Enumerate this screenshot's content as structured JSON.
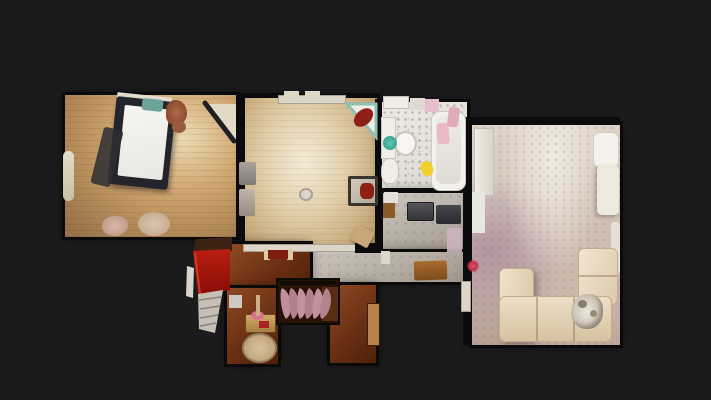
{
  "viewer": {
    "kind": "top-down dollhouse floor plan photograph",
    "background_color": "#1b1b1d",
    "visible_text": ""
  },
  "floorplan": {
    "rooms": [
      {
        "name": "bedroom",
        "floor": "tan wood",
        "floor_color": "#b98f5c",
        "items": [
          "double-bed",
          "white-mattress",
          "teal-pillow",
          "red-clothes",
          "radiator",
          "clothes-piles",
          "open-door"
        ]
      },
      {
        "name": "nursery",
        "floor": "pale wood",
        "floor_color": "#d8c49c",
        "items": [
          "corner-crib-red-blanket",
          "window-radiator",
          "wall-shelves",
          "potty",
          "dresser-red-item",
          "stool",
          "red-doormat"
        ]
      },
      {
        "name": "bathroom",
        "floor": "white tile",
        "floor_color": "#e4e1db",
        "items": [
          "bathtub",
          "vanity",
          "oval-sink",
          "teal-basin",
          "toilet",
          "pink-towels",
          "yellow-toy",
          "shelf-boxes"
        ]
      },
      {
        "name": "hallway",
        "floor": "grey screed",
        "floor_color": "#b6aea4",
        "items": [
          "washing-machine",
          "dryer",
          "brown-doormat",
          "white-shelf",
          "pink-wall-patch"
        ]
      },
      {
        "name": "living-room",
        "floor": "mottled beige carpet",
        "floor_color": "#cfc1b5",
        "items": [
          "l-shaped-cream-sofa",
          "white-armchair",
          "wall-cabinet",
          "radiator",
          "white-door",
          "dog-on-sofa"
        ]
      },
      {
        "name": "landing",
        "floor": "dark red-brown wood",
        "floor_color": "#6b3014",
        "items": [
          "curved-staircase-pink-treads",
          "red-carpet-staircase",
          "side-table-flowers",
          "oval-rug",
          "doorway-posts"
        ]
      }
    ],
    "marker": {
      "type": "scan-point-dot",
      "color": "#c23049"
    }
  },
  "palette": {
    "wall": "#0b0b0d",
    "white_wall": "#ddd6c8",
    "sofa_cream": "#e9dec5",
    "stairs_tread_pink": "#bf8e9d",
    "stairs_red": "#a31410",
    "accent_teal": "#4aa99a",
    "accent_yellow": "#f2d02b"
  }
}
